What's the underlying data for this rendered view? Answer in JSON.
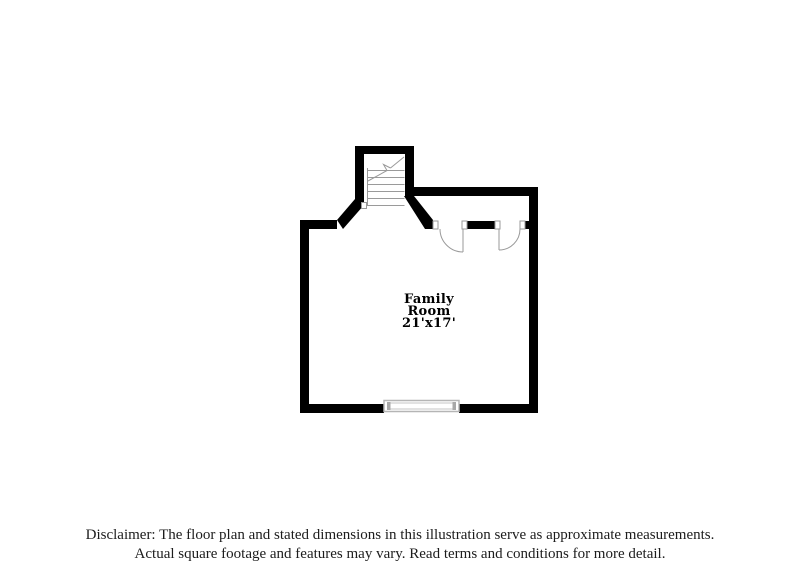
{
  "floor_plan": {
    "room": {
      "name_line1": "Family",
      "name_line2": "Room",
      "dimensions": "21'x17'"
    },
    "colors": {
      "wall": "#000000",
      "fixture_line": "#9a9a9a",
      "window_line": "#b5b5b5"
    }
  },
  "disclaimer": {
    "line1": "Disclaimer: The floor plan and stated dimensions in this illustration serve as approximate measurements.",
    "line2": "Actual square footage and features may vary. Read terms and conditions for more detail."
  }
}
